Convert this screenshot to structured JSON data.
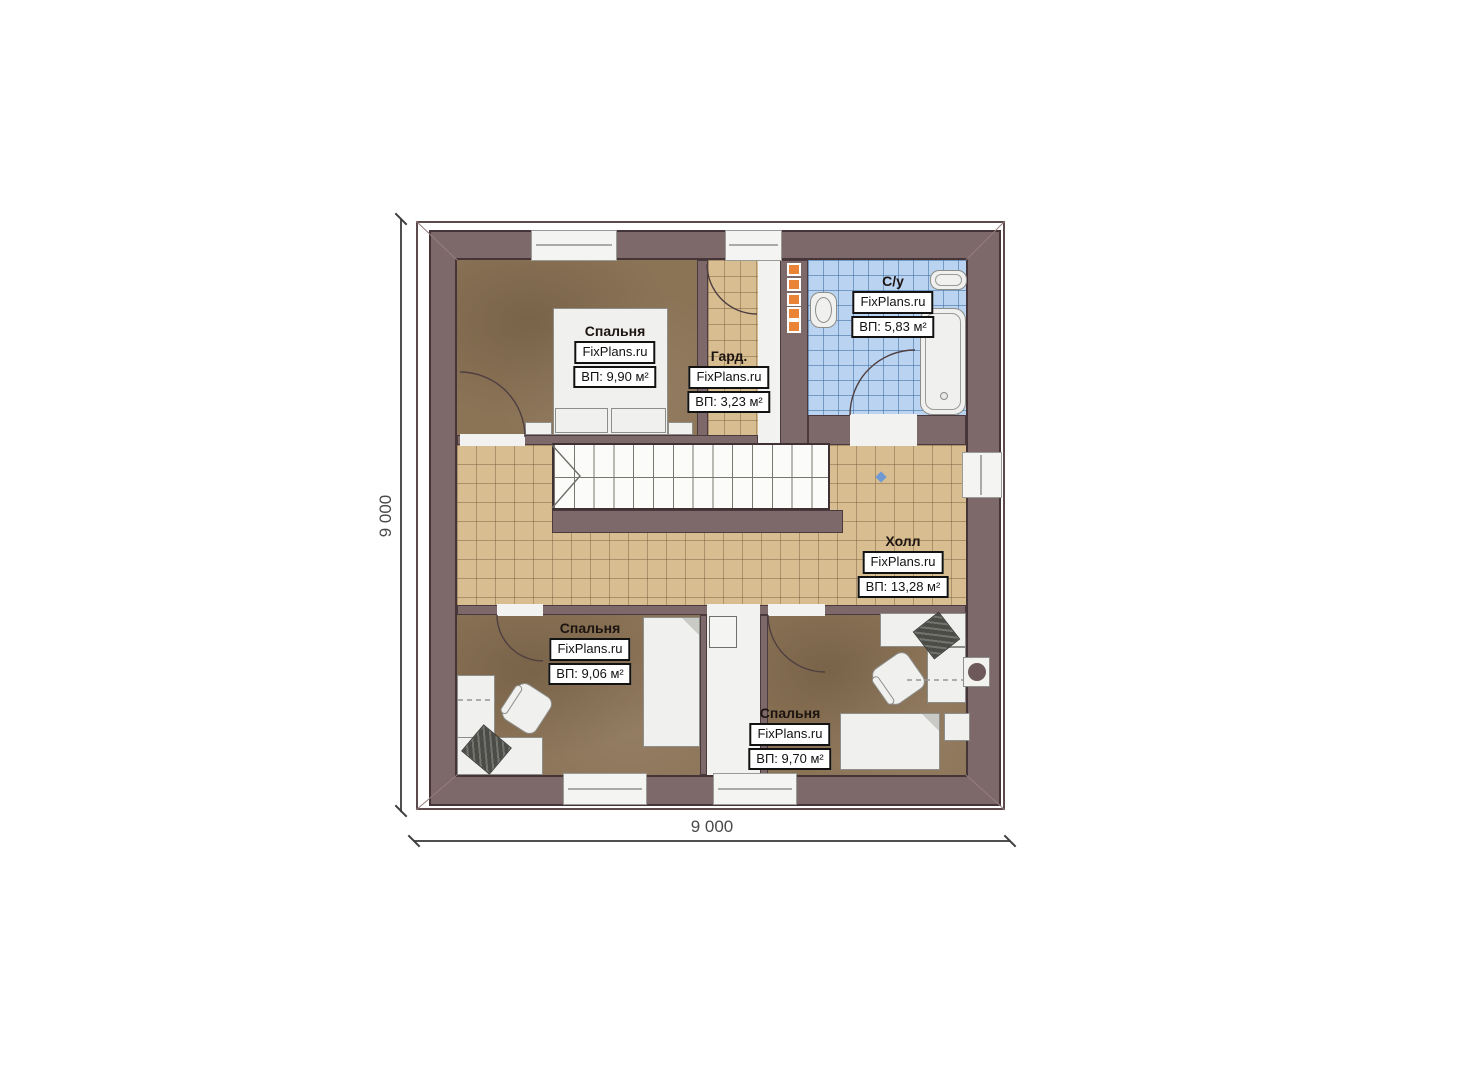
{
  "plan_title": "attic-floor-plan",
  "dimensions": {
    "width_label": "9 000",
    "height_label": "9 000"
  },
  "rooms": [
    {
      "id": "bedroom-top",
      "name": "Спальня",
      "brand": "FixPlans.ru",
      "area": "ВП: 9,90 м²"
    },
    {
      "id": "wardrobe",
      "name": "Гард.",
      "brand": "FixPlans.ru",
      "area": "ВП: 3,23 м²"
    },
    {
      "id": "bathroom",
      "name": "С/у",
      "brand": "FixPlans.ru",
      "area": "ВП: 5,83 м²"
    },
    {
      "id": "hall",
      "name": "Холл",
      "brand": "FixPlans.ru",
      "area": "ВП: 13,28 м²"
    },
    {
      "id": "bedroom-left",
      "name": "Спальня",
      "brand": "FixPlans.ru",
      "area": "ВП: 9,06 м²"
    },
    {
      "id": "bedroom-right",
      "name": "Спальня",
      "brand": "FixPlans.ru",
      "area": "ВП: 9,70 м²"
    }
  ],
  "colors": {
    "wall": "#7d686a",
    "wall_outline": "#463538",
    "bedroom_floor": "#8b7356",
    "hall_tile": "#d7bd90",
    "bathroom_tile": "#b9d3f0",
    "furniture": "#f0f0ee",
    "towel_rail_accent": "#e98436",
    "dimension_text": "#4a4a4a"
  }
}
